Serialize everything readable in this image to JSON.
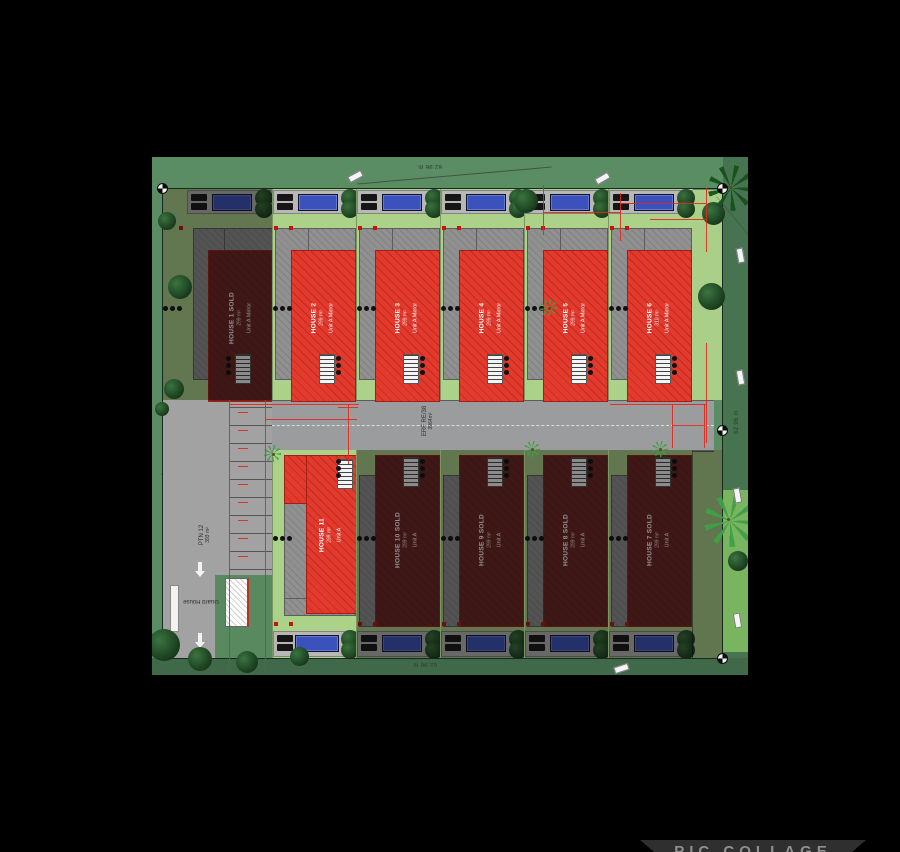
{
  "plan": {
    "road": {
      "erf_label": "ERF RE/38",
      "erf_area": "3964m²"
    },
    "parking": {
      "label": "PTN 12",
      "area": "393 m²"
    },
    "guard_house": {
      "label": "Guard House"
    },
    "dimensions": {
      "top": "62.96 m",
      "right": "62.96 m",
      "bottom": "62.96 m"
    },
    "houses": [
      {
        "id": 1,
        "name": "HOUSE 1 SOLD",
        "area": "299 m²",
        "unit": "Unit A Mirror",
        "sold": true,
        "row": "top",
        "col": 0
      },
      {
        "id": 2,
        "name": "HOUSE 2",
        "area": "299 m²",
        "unit": "Unit A Mirror",
        "sold": false,
        "row": "top",
        "col": 1
      },
      {
        "id": 3,
        "name": "HOUSE 3",
        "area": "299 m²",
        "unit": "Unit A Mirror",
        "sold": false,
        "row": "top",
        "col": 2
      },
      {
        "id": 4,
        "name": "HOUSE 4",
        "area": "299 m²",
        "unit": "Unit A Mirror",
        "sold": false,
        "row": "top",
        "col": 3
      },
      {
        "id": 5,
        "name": "HOUSE 5",
        "area": "299 m²",
        "unit": "Unit A Mirror",
        "sold": false,
        "row": "top",
        "col": 4
      },
      {
        "id": 6,
        "name": "HOUSE 6",
        "area": "310 m²",
        "unit": "Unit A Mirror",
        "sold": false,
        "row": "top",
        "col": 5
      },
      {
        "id": 11,
        "name": "HOUSE 11",
        "area": "299 m²",
        "unit": "Unit A",
        "sold": false,
        "row": "bottom",
        "col": 1
      },
      {
        "id": 10,
        "name": "HOUSE 10 SOLD",
        "area": "299 m²",
        "unit": "Unit A",
        "sold": true,
        "row": "bottom",
        "col": 2
      },
      {
        "id": 9,
        "name": "HOUSE 9 SOLD",
        "area": "299 m²",
        "unit": "Unit A",
        "sold": true,
        "row": "bottom",
        "col": 3
      },
      {
        "id": 8,
        "name": "HOUSE 8 SOLD",
        "area": "299 m²",
        "unit": "Unit A",
        "sold": true,
        "row": "bottom",
        "col": 4
      },
      {
        "id": 7,
        "name": "HOUSE 7 SOLD",
        "area": "299 m²",
        "unit": "Unit A",
        "sold": true,
        "row": "bottom",
        "col": 5
      }
    ],
    "colors": {
      "available_roof": "#e23a2c",
      "sold_roof": "#6a2622",
      "pool": "#3b51bb",
      "grass": "#5b8d64",
      "road": "#9b9c9e"
    }
  },
  "watermark": {
    "app_name": "PIC COLLAGE"
  }
}
